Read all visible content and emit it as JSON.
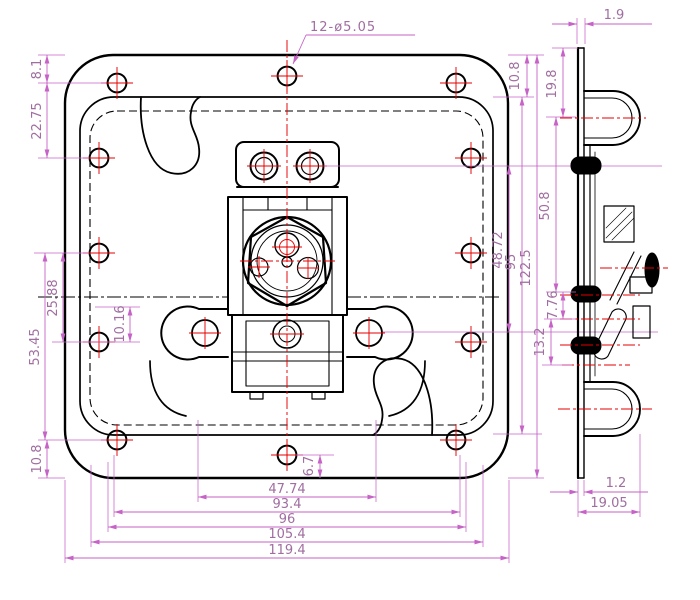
{
  "colors": {
    "background": "#ffffff",
    "outline": "#000000",
    "centerline": "#e60000",
    "dimension_line": "#c663c6",
    "dimension_text": "#a06ea0"
  },
  "dims": {
    "hole_callout": "12-ø5.05",
    "front_left": [
      "8.1",
      "22.75",
      "25.88",
      "53.45",
      "10.16",
      "10.8"
    ],
    "front_right": [
      "10.8",
      "48.72",
      "95",
      "122.5"
    ],
    "front_bottom": [
      "47.74",
      "93.4",
      "96",
      "105.4",
      "119.4"
    ],
    "front_center": [
      "6.7"
    ],
    "side_top": [
      "1.9"
    ],
    "side_left": [
      "19.8",
      "50.8",
      "7.76",
      "13.2"
    ],
    "side_bottom": [
      "1.2",
      "19.05"
    ]
  }
}
